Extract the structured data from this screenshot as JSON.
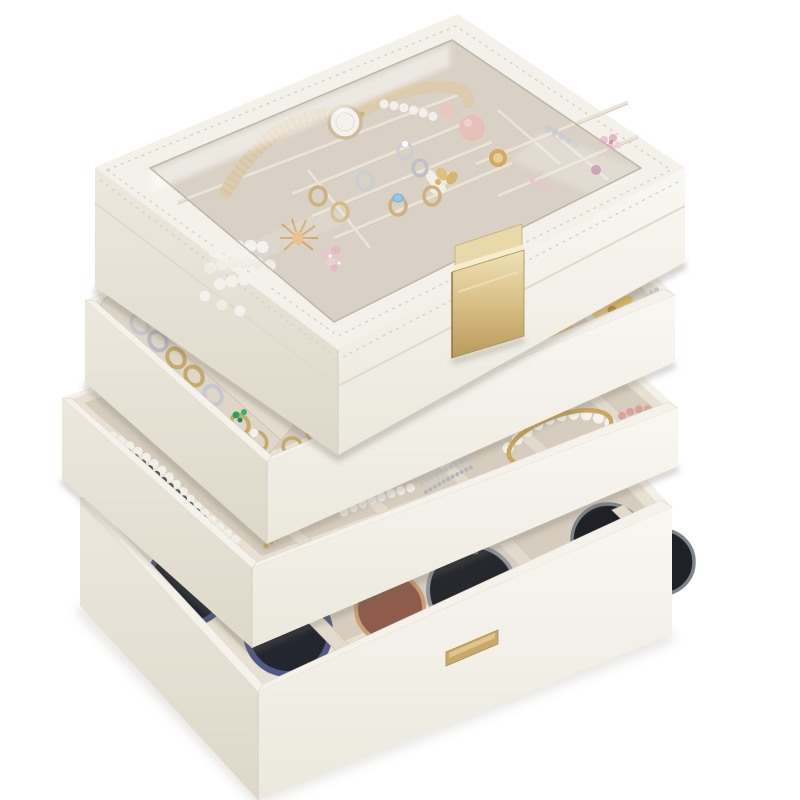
{
  "scene": {
    "description": "Product photograph of a four-tier stackable jewelry organizer on a white background. Four cream PU-leather trays are stacked in a staggered cascade: a top box with a glass-window lid and gold flip clasp, two open jewelry trays, and a deep bottom tray holding sunglasses.",
    "product": "4-layer stackable jewelry box organizer, cream white with beige velvet lining",
    "background_color": "#ffffff"
  },
  "colors": {
    "background": "#ffffff",
    "leather_top": "#f4f1ea",
    "leather_left": "#e9e5da",
    "leather_front": "#f8f6f1",
    "leather_edge": "#ded8ca",
    "velvet": "#d6cdbf",
    "velvet_wall": "#e7e0d3",
    "velvet_bar": "#e2dacc",
    "gold": "#c9a96b",
    "gold_light": "#ead9a8",
    "gold_bright": "#f6edcf",
    "silver": "#c6c8cd",
    "pearl": "#f4f1ec",
    "emerald": "#2f9e5f",
    "blush": "#e5b9b1",
    "watch_strap": "#d9c6a4",
    "navy_rim": "#4a5480",
    "lens_navy": "#202430",
    "lens_rose": "#8f5c4b",
    "lens_dark": "#26282e",
    "lens_dark2": "#1f2127",
    "shadow": "rgba(110,104,88,0.30)"
  },
  "hardware": {
    "clasp": "gold metal flip-lock buckle on the front of the top box",
    "nameplate": "small gold brand nameplate on the bottom tray (text too small to read)",
    "lid": "clear glass window lid with stitched white leather frame"
  },
  "trays": [
    {
      "id": "top-box",
      "label": "Top box with glass lid",
      "contents": [
        "beige leather wristwatch",
        "pearl strand",
        "silver crystal cluster",
        "pink satin spheres",
        "gold rose brooch",
        "white orchid brooch",
        "pink crystal drops",
        "pink flower brooch",
        "assorted rings: gold, silver, blue topaz, diamond, butterfly",
        "pearl necklace pile",
        "gold-orange spray brooch"
      ]
    },
    {
      "id": "tray-2",
      "label": "Ring tray",
      "contents": [
        "silver and gold rings in velvet ring rolls",
        "emerald ring",
        "pearl ring",
        "gold wire rings",
        "silver rings",
        "white crystal spray",
        "gold flower with amber gem",
        "two gold daisy brooches",
        "silver jewels"
      ]
    },
    {
      "id": "tray-3",
      "label": "Necklace and bracelet tray",
      "contents": [
        "black-and-silver crystal cluster necklace",
        "gold chain",
        "pearl strand",
        "silver chains",
        "white pearl bracelet",
        "thin gold bangle",
        "blush bead bracelet"
      ]
    },
    {
      "id": "tray-4",
      "label": "Deep sunglasses tray",
      "contents": [
        "navy-rimmed sunglasses",
        "rose-tinted sunglasses",
        "dark grey sunglasses",
        "black sunglasses",
        "velvet slot dividers"
      ]
    }
  ]
}
